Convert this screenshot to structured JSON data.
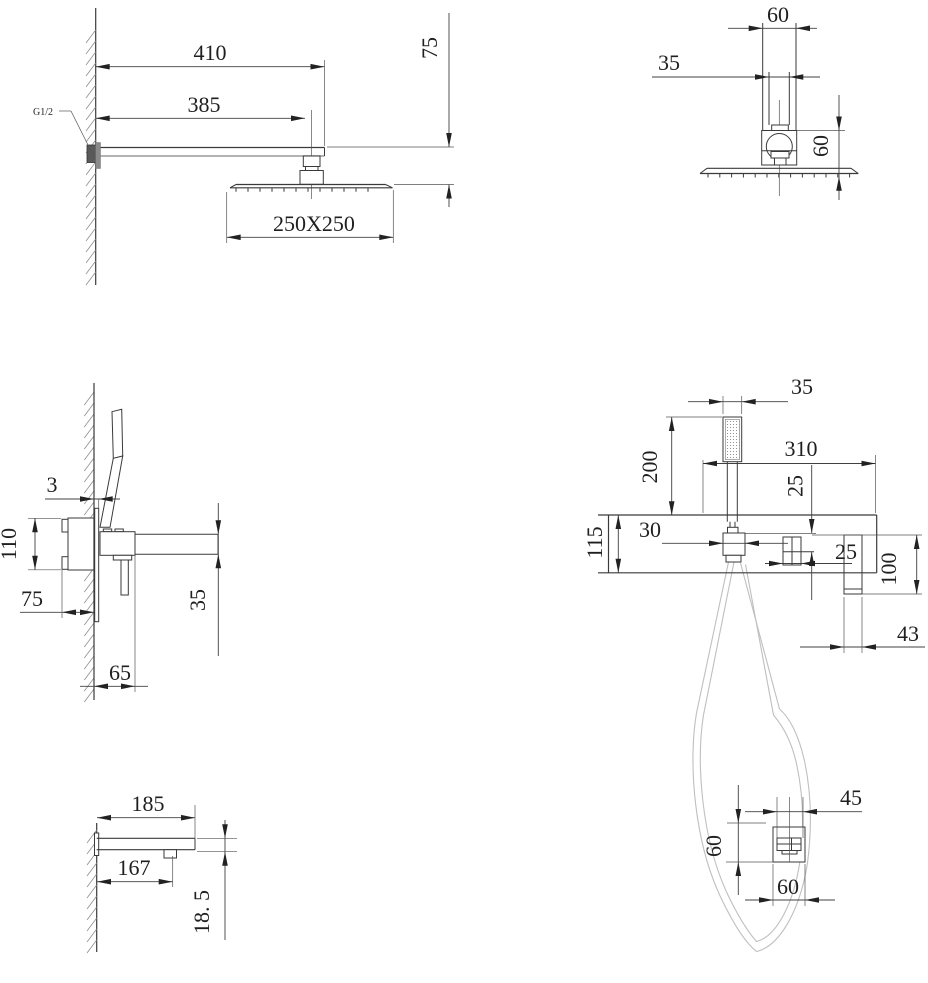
{
  "drawings": {
    "overhead_side": {
      "dim_arm_length": "410",
      "dim_arm_to_head": "385",
      "dim_head_drop": "75",
      "dim_head_size": "250X250",
      "label_thread": "G1/2"
    },
    "overhead_front": {
      "dim_arm_width": "60",
      "dim_neck_width": "35",
      "dim_connector_height": "60"
    },
    "mixer_side": {
      "dim_plate_gap": "3",
      "dim_valve_height": "110",
      "dim_recess_depth": "75",
      "dim_projection": "65",
      "dim_spout_thickness": "35"
    },
    "mixer_front": {
      "dim_handshower_width": "35",
      "dim_handshower_height": "200",
      "dim_plate_width": "310",
      "dim_holder_drop": "25",
      "dim_holder_width": "30",
      "dim_plate_height": "115",
      "dim_control_size": "25",
      "dim_handle_height": "100",
      "dim_handle_width": "43"
    },
    "spout_side": {
      "dim_length": "185",
      "dim_outlet_offset": "167",
      "dim_thickness": "18. 5"
    },
    "wall_outlet": {
      "dim_offset": "45",
      "dim_height": "60",
      "dim_width": "60"
    }
  }
}
